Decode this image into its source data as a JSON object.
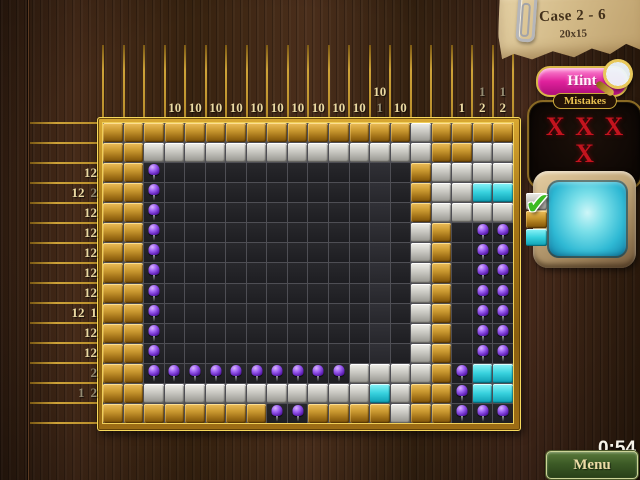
{
  "side_panel": {
    "case_card": {
      "title": "Case 2 - 6",
      "size": "20x15"
    },
    "hint_button": {
      "label": "Hint",
      "icon": "magnifier-icon"
    },
    "mistakes": {
      "label": "Mistakes",
      "row1": "X X X",
      "row2": "X",
      "count": 4
    },
    "tv": {
      "check_glyph": "✔",
      "icon": "tv-monitor"
    },
    "timer": "0:54",
    "menu_button": {
      "label": "Menu"
    }
  },
  "board": {
    "cols": 20,
    "rows": 15,
    "highlighted_column": 14,
    "col_clues": [
      [],
      [],
      [],
      [
        "10"
      ],
      [
        "10"
      ],
      [
        "10"
      ],
      [
        "10"
      ],
      [
        "10"
      ],
      [
        "10"
      ],
      [
        "10"
      ],
      [
        "10"
      ],
      [
        "10"
      ],
      [
        "10"
      ],
      [
        "10",
        "*1"
      ],
      [
        "10"
      ],
      [],
      [],
      [
        "1"
      ],
      [
        "*1",
        "2"
      ],
      [
        "*1",
        "2"
      ]
    ],
    "row_clues": [
      [],
      [],
      [
        "12"
      ],
      [
        "12",
        "*2"
      ],
      [
        "12"
      ],
      [
        "12"
      ],
      [
        "12"
      ],
      [
        "12"
      ],
      [
        "12"
      ],
      [
        "12",
        "1"
      ],
      [
        "12"
      ],
      [
        "12"
      ],
      [
        "*2"
      ],
      [
        "*1",
        "*2"
      ],
      []
    ],
    "cells": [
      "GGGGGGGGGGGGGGGgGGGG",
      "GGggggggggggggggGGgg",
      "GGPddddddddddddGgggg",
      "GGPddddddddddddGggcc",
      "GGPddddddddddddGgggg",
      "GGPddddddddddddgGdPP",
      "GGPddddddddddddgGdPP",
      "GGPddddddddddddgGdPP",
      "GGPddddddddddddgGdPP",
      "GGPddddddddddddgGdPP",
      "GGPddddddddddddgGdPP",
      "GGPddddddddddddgGdPP",
      "GGPPPPPPPPPPggggGPcc",
      "GGgggggggggggcgGGPcc",
      "GGGGGGGGPPGGGGgGGPPP"
    ],
    "legend": {
      "G": "unopened-gold-tile",
      "g": "marked-empty-gray-tile",
      "d": "unknown-dark-cell",
      "P": "pushpin-filled-cell",
      "c": "cyan-filled-cell"
    }
  },
  "colors": {
    "clue-bright": "#ead9a2",
    "clue-dim": "#938b72",
    "gold-line": "#cda238",
    "mistake-red": "#c3141e",
    "hint-pink": "#e0219c",
    "menu-green": "#3c5a26",
    "timer-white": "#f6f3e9",
    "pin-purple": "#9a5cf0",
    "tv-screen-cyan": "#2fb9d4"
  }
}
